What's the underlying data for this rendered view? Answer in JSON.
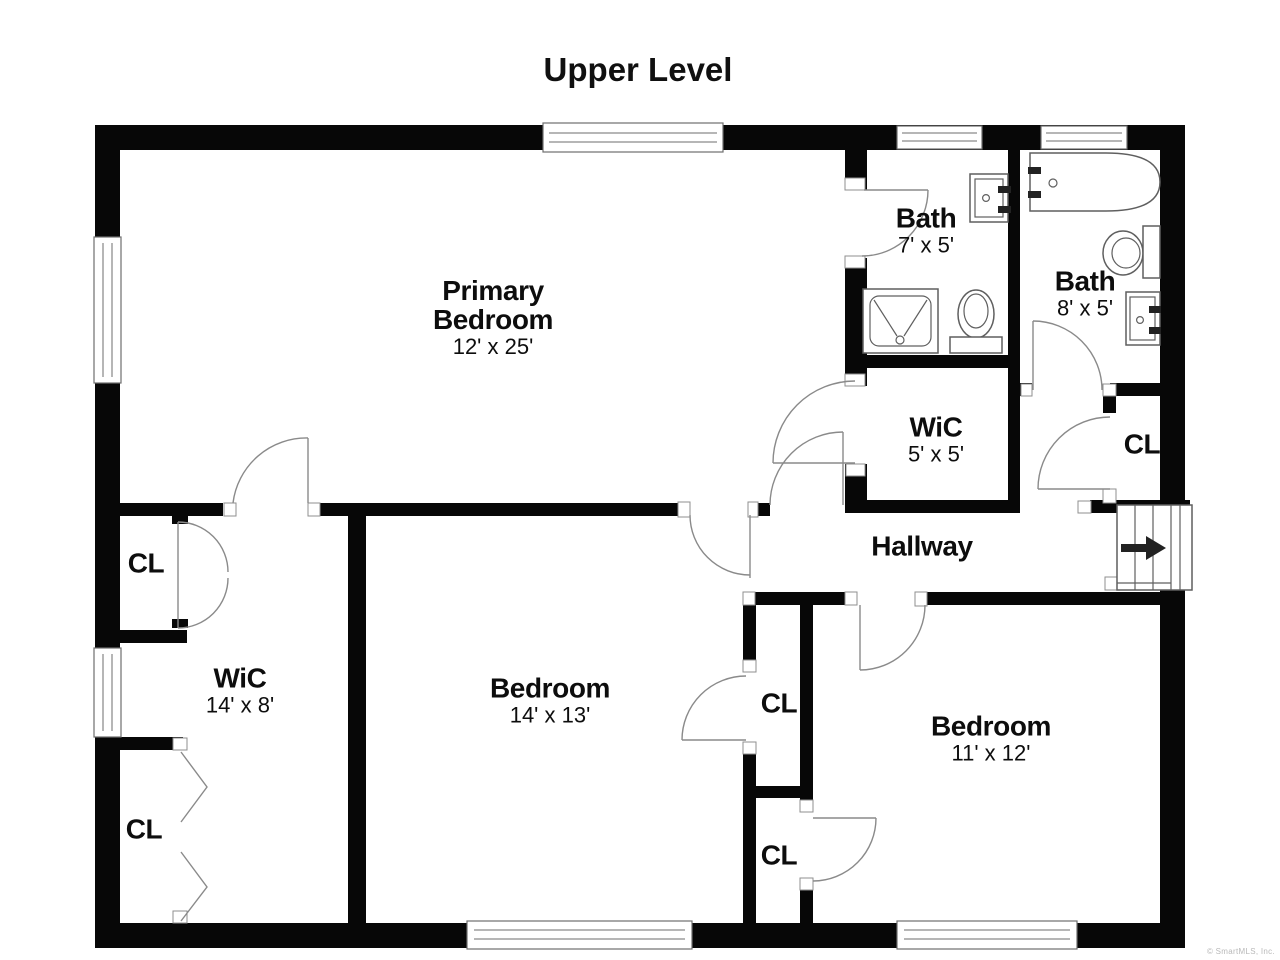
{
  "title": "Upper Level",
  "watermark": "© SmartMLS, Inc.",
  "rooms": {
    "primary_bedroom": {
      "name": "Primary Bedroom",
      "dims": "12' x 25'"
    },
    "bath_small": {
      "name": "Bath",
      "dims": "7' x 5'"
    },
    "bath_large": {
      "name": "Bath",
      "dims": "8' x 5'"
    },
    "wic_small": {
      "name": "WiC",
      "dims": "5' x 5'"
    },
    "closet_right": {
      "name": "CL",
      "dims": ""
    },
    "hallway": {
      "name": "Hallway",
      "dims": ""
    },
    "closet_left_top": {
      "name": "CL",
      "dims": ""
    },
    "wic_left": {
      "name": "WiC",
      "dims": "14' x 8'"
    },
    "closet_left_bottom": {
      "name": "CL",
      "dims": ""
    },
    "bedroom_center": {
      "name": "Bedroom",
      "dims": "14' x 13'"
    },
    "closet_mid_top": {
      "name": "CL",
      "dims": ""
    },
    "closet_mid_bottom": {
      "name": "CL",
      "dims": ""
    },
    "bedroom_right": {
      "name": "Bedroom",
      "dims": "11' x 12'"
    }
  }
}
